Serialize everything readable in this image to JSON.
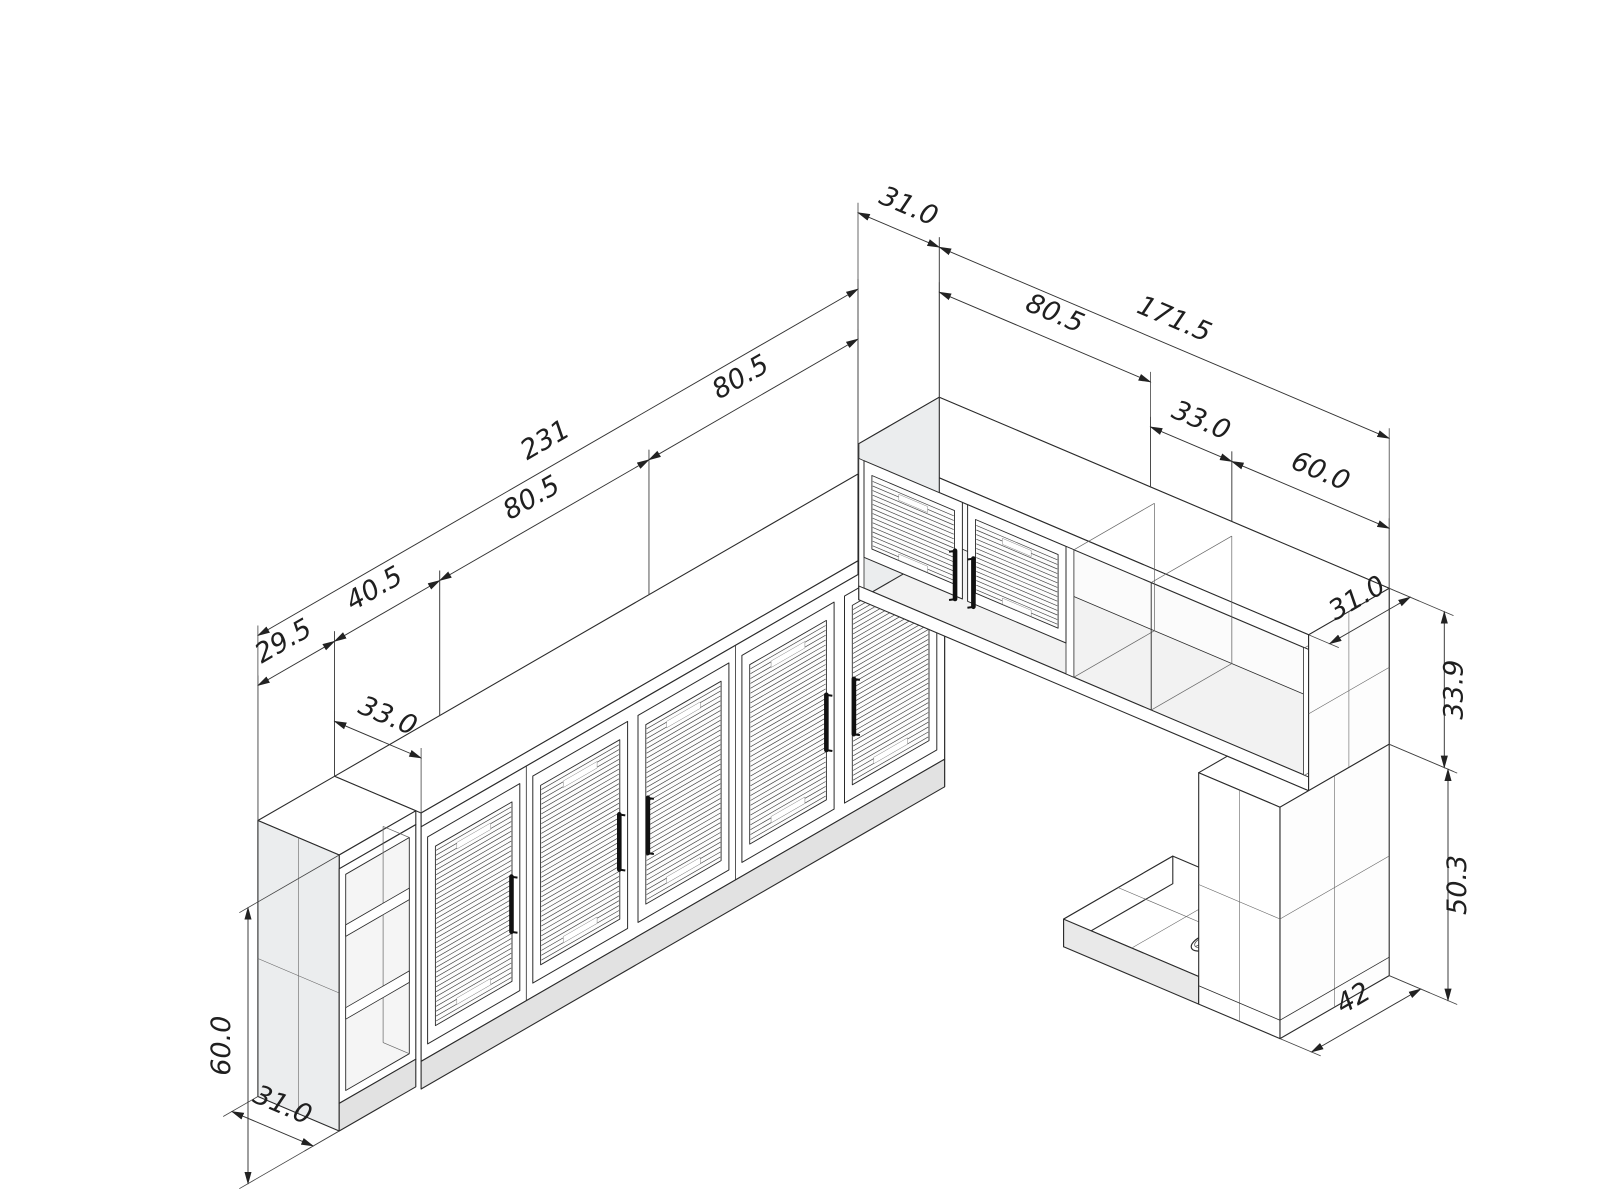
{
  "drawing": {
    "background": "#ffffff",
    "line_color": "#2b2b2b",
    "dim_color": "#333333",
    "label_color": "#1f1f1f",
    "side_panel_fill": "#ebedee",
    "plinth_fill": "#e2e2e2",
    "interior_fill": "#f5f5f5",
    "bottom_fill": "#f2f2f2",
    "shading_fill": "#ececec",
    "back_fill": "#fbfbfb",
    "slat_color": "#474747"
  },
  "dimensions": {
    "left_run": {
      "segment_end": "29.5",
      "segment_small": "40.5",
      "segment_a": "80.5",
      "segment_b": "80.5",
      "total": "231",
      "cabinet_depth": "33.0",
      "end_unit_depth": "31.0",
      "height": "60.0"
    },
    "right_run": {
      "corner_offset": "31.0",
      "total": "171.5",
      "wall_cabinet_width": "80.5",
      "open_section_width": "33.0",
      "shelf_unit_width": "60.0",
      "shelf_unit_depth": "31.0",
      "upper_height": "33.9",
      "lower_height": "50.3",
      "base_depth": "42"
    }
  }
}
